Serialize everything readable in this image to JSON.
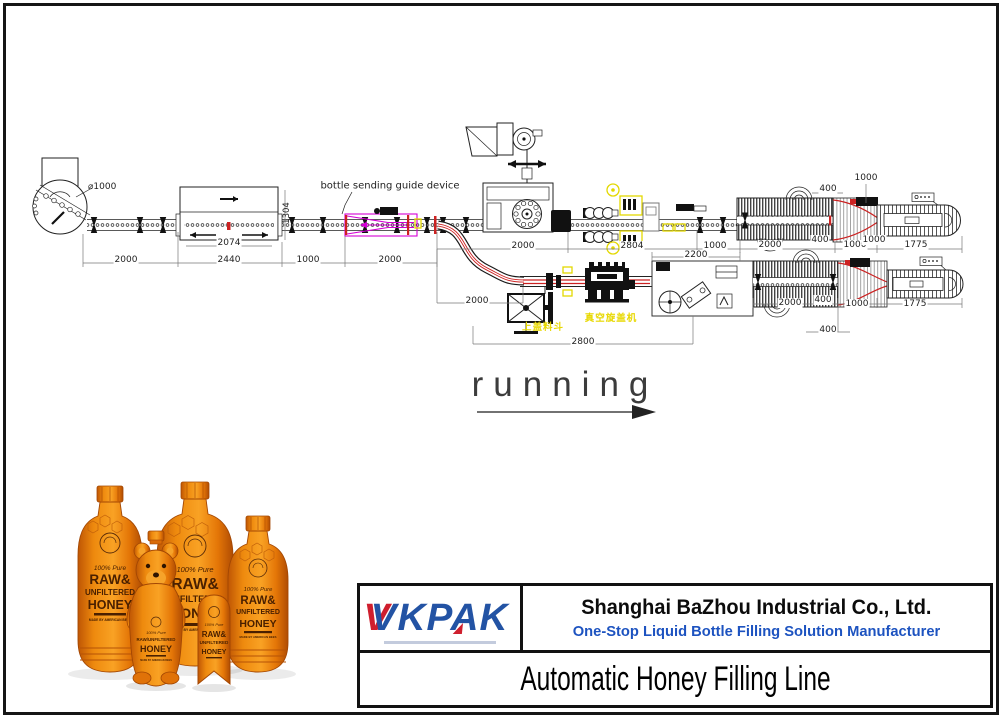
{
  "diagram": {
    "running_label": "running",
    "guide_device_label": "bottle sending guide device",
    "turntable_diameter": "⌀1000",
    "machine_side_dim": "1304",
    "cap_feed_cn": "上盖料斗",
    "vacuum_capper_cn": "真空旋盖机",
    "dimensions": [
      {
        "text": "2000",
        "x": 126,
        "y": 260
      },
      {
        "text": "2440",
        "x": 229,
        "y": 260
      },
      {
        "text": "1000",
        "x": 308,
        "y": 260
      },
      {
        "text": "2000",
        "x": 390,
        "y": 260
      },
      {
        "text": "2074",
        "x": 229,
        "y": 243
      },
      {
        "text": "2000",
        "x": 523,
        "y": 246
      },
      {
        "text": "2804",
        "x": 632,
        "y": 246
      },
      {
        "text": "1000",
        "x": 715,
        "y": 246
      },
      {
        "text": "2200",
        "x": 696,
        "y": 255
      },
      {
        "text": "2000",
        "x": 770,
        "y": 245
      },
      {
        "text": "400",
        "x": 820,
        "y": 240
      },
      {
        "text": "1000",
        "x": 855,
        "y": 245
      },
      {
        "text": "1000",
        "x": 874,
        "y": 240
      },
      {
        "text": "1775",
        "x": 916,
        "y": 245
      },
      {
        "text": "1000",
        "x": 866,
        "y": 178
      },
      {
        "text": "400",
        "x": 828,
        "y": 189
      },
      {
        "text": "2000",
        "x": 477,
        "y": 301
      },
      {
        "text": "2800",
        "x": 583,
        "y": 342
      },
      {
        "text": "2000",
        "x": 790,
        "y": 303
      },
      {
        "text": "400",
        "x": 823,
        "y": 300
      },
      {
        "text": "1000",
        "x": 857,
        "y": 304
      },
      {
        "text": "1775",
        "x": 915,
        "y": 304
      },
      {
        "text": "400",
        "x": 828,
        "y": 330
      }
    ]
  },
  "products": {
    "pure": "100% Pure",
    "raw": "RAW&",
    "unfiltered": "UNFILTERED",
    "honey": "HONEY",
    "raw_unfiltered": "RAW/UNFILTERED",
    "made_by": "MADE BY AMERICAN BEES"
  },
  "footer": {
    "logo_text": "VKPAK",
    "logo_red_accent": "V",
    "company_name": "Shanghai BaZhou Industrial Co., Ltd.",
    "tagline": "One-Stop Liquid Bottle Filling Solution Manufacturer",
    "product_title": "Automatic Honey Filling Line"
  },
  "colors": {
    "logo_blue": "#2353a4",
    "logo_red": "#cf1f2e",
    "tagline_blue": "#1d53c0",
    "highlight_yellow": "#e3d800",
    "guide_magenta": "#d400d4",
    "conveyor_red": "#cc2222",
    "honey_orange": "#ef8a0e"
  }
}
